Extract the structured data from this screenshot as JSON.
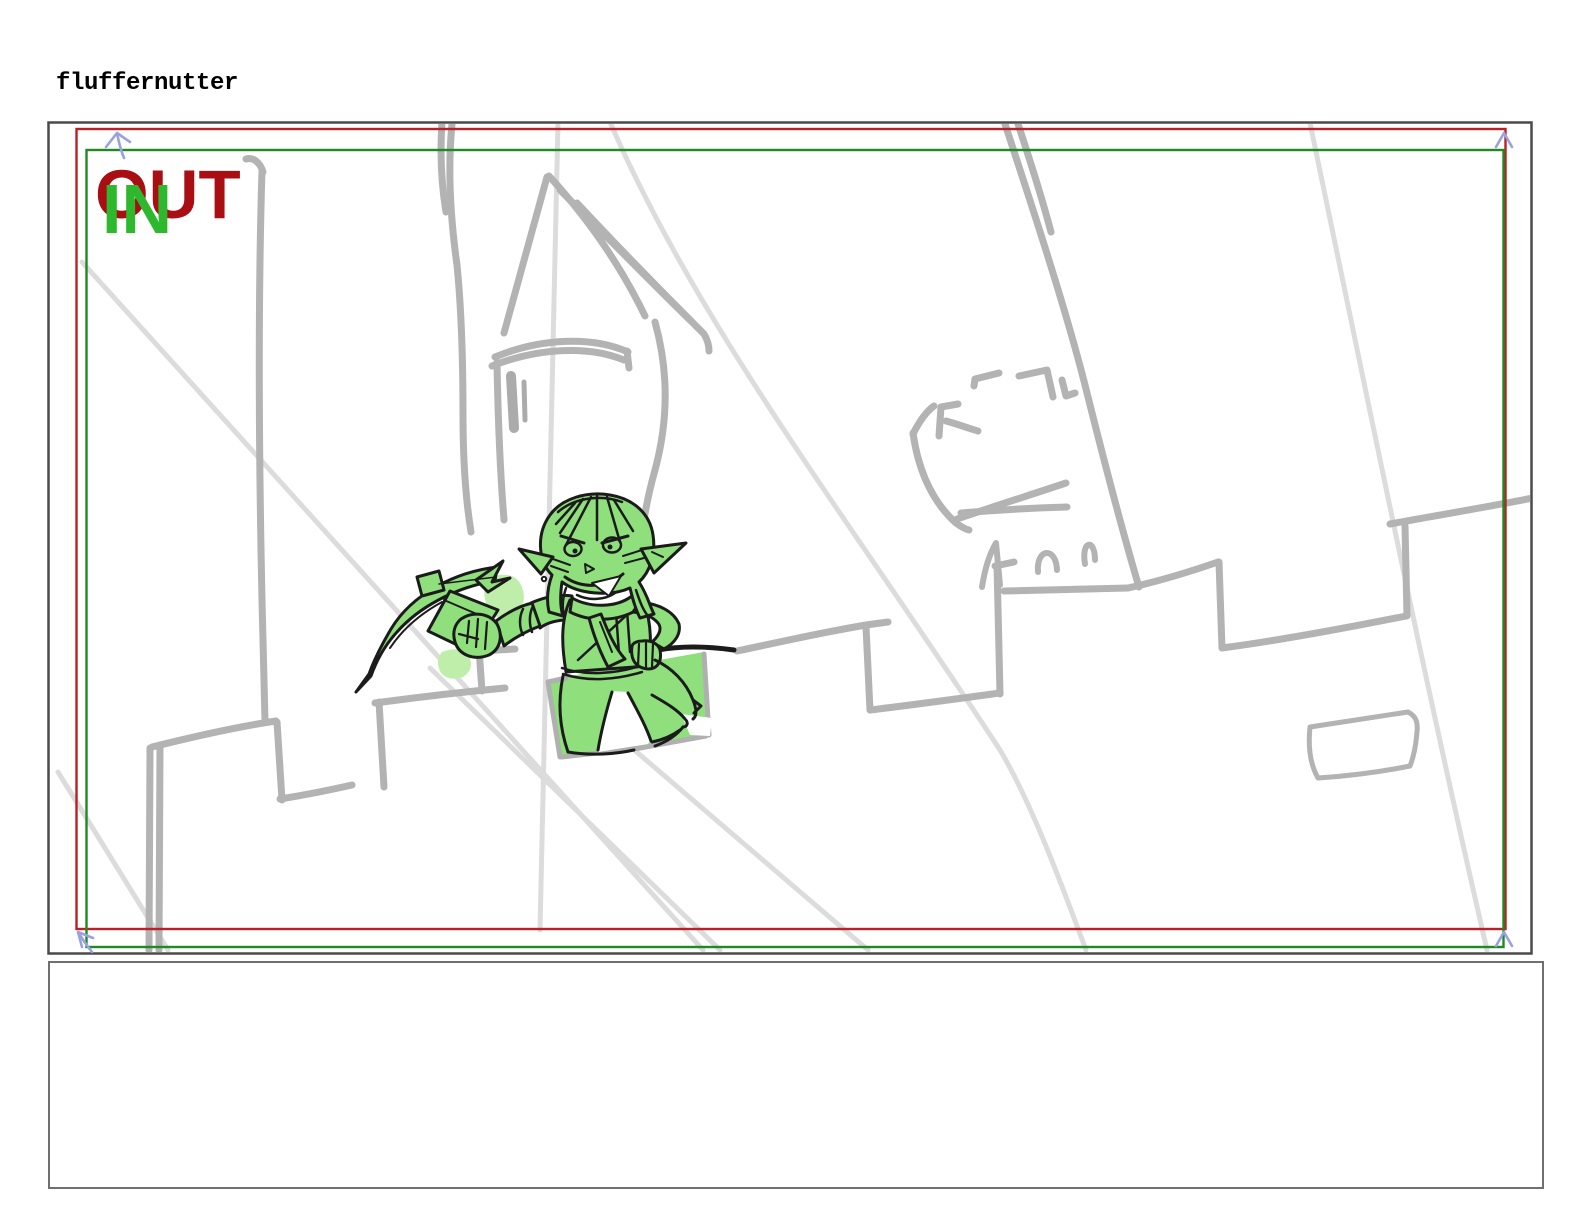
{
  "title": "fluffernutter",
  "panel": {
    "out_label": "OUT",
    "in_label": "IN"
  },
  "caption": {
    "text": ""
  },
  "colors": {
    "out_frame": "#bb2025",
    "in_frame": "#1f8a21",
    "out_text": "#a90e13",
    "in_text": "#2eb82e",
    "motion_arrow": "#9aa2dd",
    "sketch_line": "#b3b3b3",
    "sketch_line_dark": "#ababab",
    "construction_line": "#dcdcdc",
    "character_fill": "#8fe07c",
    "character_highlight": "#bfeeab",
    "ink": "#1b1b1b",
    "panel_border": "#4a4a4a",
    "caption_border": "#6f6f6f"
  }
}
